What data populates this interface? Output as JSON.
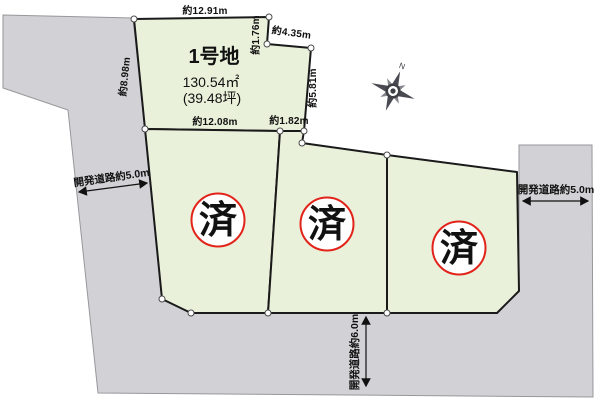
{
  "plot1": {
    "name": "1号地",
    "area": "130.54㎡",
    "area_tsubo": "(39.48坪)",
    "dimensions": {
      "top": "約12.91m",
      "left": "約8.98m",
      "ne_vertical": "約1.76m",
      "ne_diagonal": "約4.35m",
      "right": "約5.81m",
      "bottom": "約12.08m",
      "bottom_right": "約1.82m"
    }
  },
  "sold_stamps": [
    {
      "label": "済"
    },
    {
      "label": "済"
    },
    {
      "label": "済"
    }
  ],
  "roads": {
    "left": {
      "label": "開発道路約5.0m"
    },
    "right": {
      "label": "開発道路約5.0m"
    },
    "bottom": {
      "label": "開発道路約6.0m"
    }
  },
  "compass": {
    "north_label": "N"
  },
  "colors": {
    "plot_fill": "#eaf1da",
    "road_fill": "#d2d2d6",
    "outline": "#1a1a1a",
    "stamp_red": "#e2231a"
  }
}
